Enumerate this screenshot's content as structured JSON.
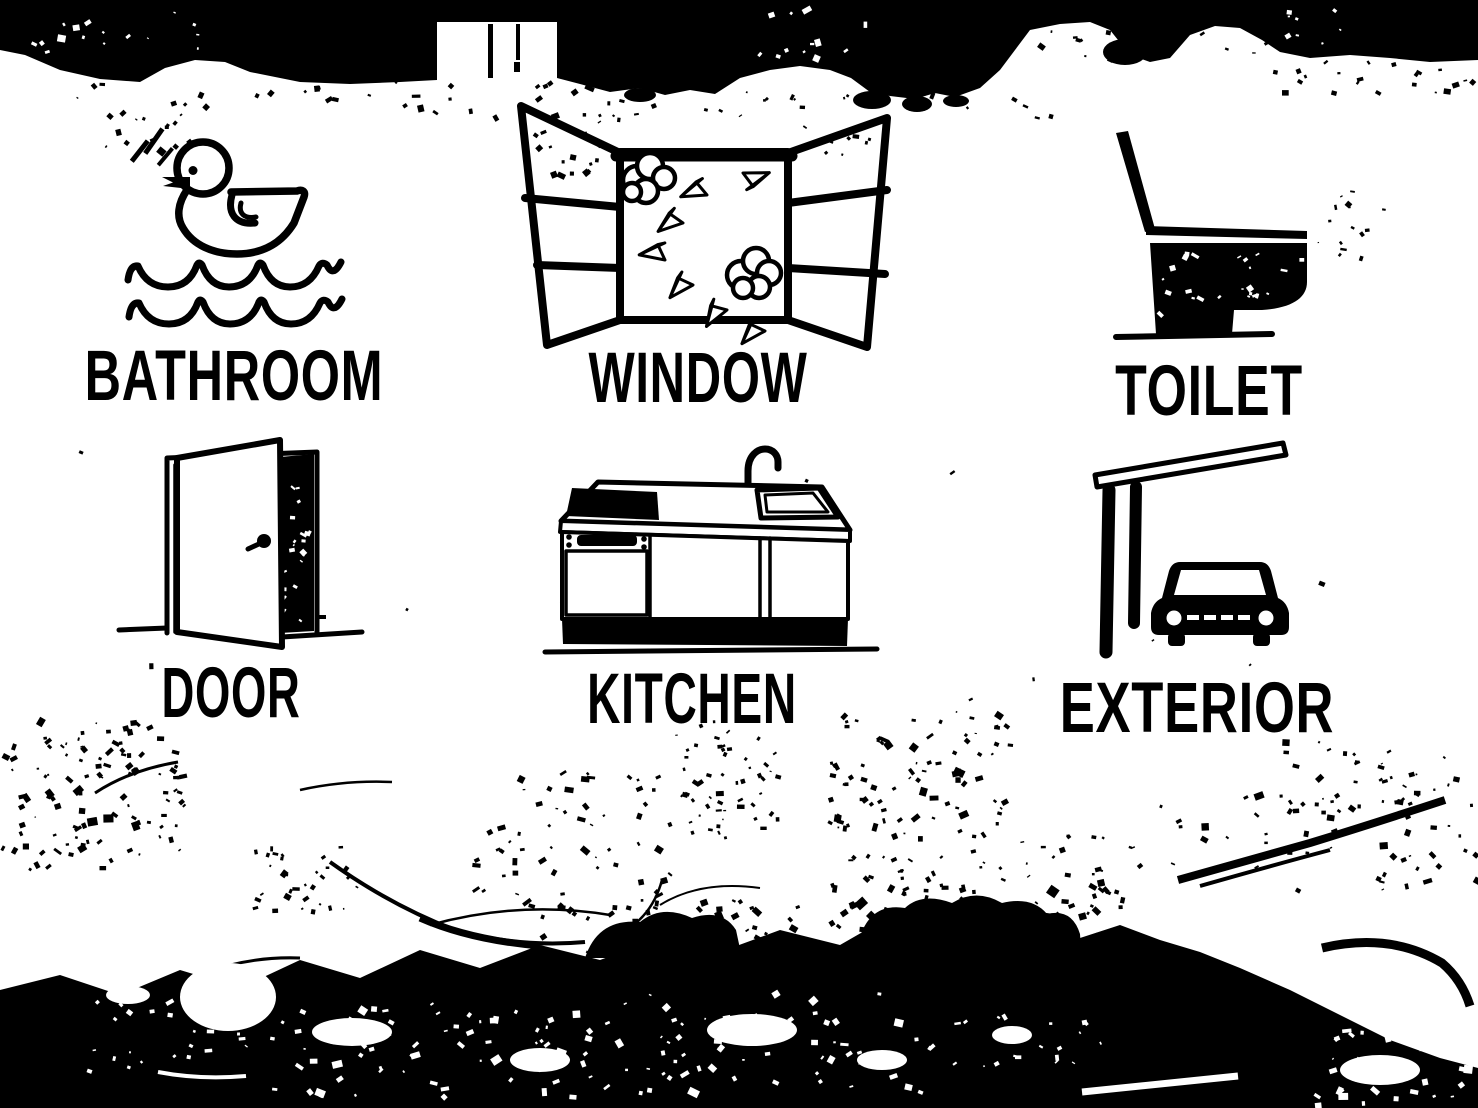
{
  "scene": {
    "description": "High-contrast black-and-white photo of an outdoor signboard with six labeled house pictograms",
    "ink_color": "#000000",
    "paper_color": "#ffffff"
  },
  "tiles": [
    {
      "label": "BATHROOM",
      "icon": "rubber-duck-on-waves-icon"
    },
    {
      "label": "WINDOW",
      "icon": "open-window-paper-planes-icon"
    },
    {
      "label": "TOILET",
      "icon": "toilet-side-view-icon"
    },
    {
      "label": "DOOR",
      "icon": "open-door-icon"
    },
    {
      "label": "KITCHEN",
      "icon": "kitchen-sink-unit-icon"
    },
    {
      "label": "EXTERIOR",
      "icon": "carport-with-car-icon"
    }
  ]
}
